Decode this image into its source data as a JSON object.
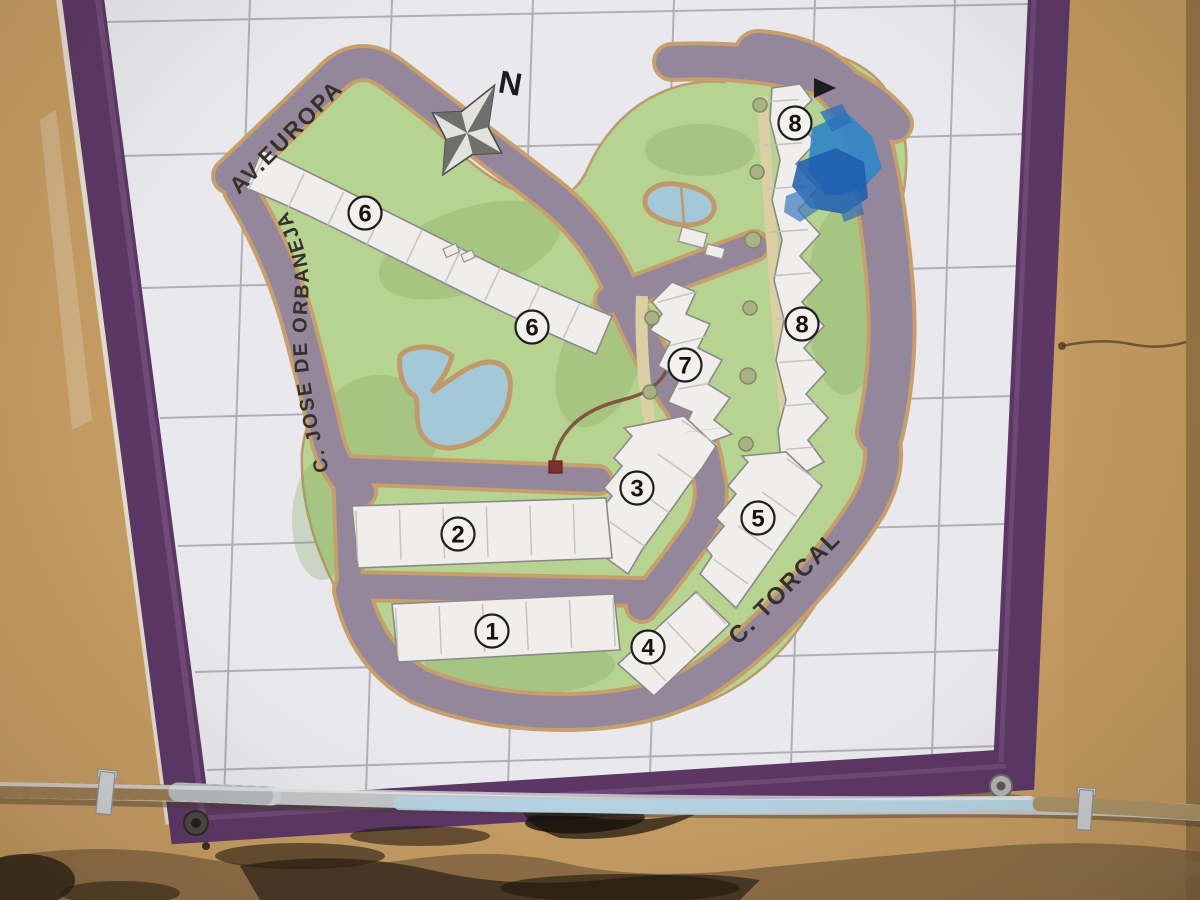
{
  "map": {
    "compass_label": "N",
    "streets": {
      "av_europa": "AV.EUROPA",
      "jose_de_orbaneja": "C. JOSE DE ORBANEJA",
      "torcal": "C. TORCAL"
    },
    "building_labels": [
      {
        "number": "6"
      },
      {
        "number": "6"
      },
      {
        "number": "7"
      },
      {
        "number": "8"
      },
      {
        "number": "8"
      },
      {
        "number": "3"
      },
      {
        "number": "5"
      },
      {
        "number": "2"
      },
      {
        "number": "1"
      },
      {
        "number": "4"
      }
    ],
    "colors": {
      "wall": "#c59c63",
      "frame_purple": "#5c3766",
      "tile_white": "#e9e9ed",
      "grout": "#a6a6ae",
      "lawn_green": "#b7d392",
      "road_mauve": "#94869b",
      "road_edge_tan": "#c79f6b",
      "building_white": "#efeeec",
      "water_blue": "#a3c9d9",
      "paint_mark_blue": "#2b6fbb",
      "pipe_gray": "#c4c6c6"
    }
  }
}
